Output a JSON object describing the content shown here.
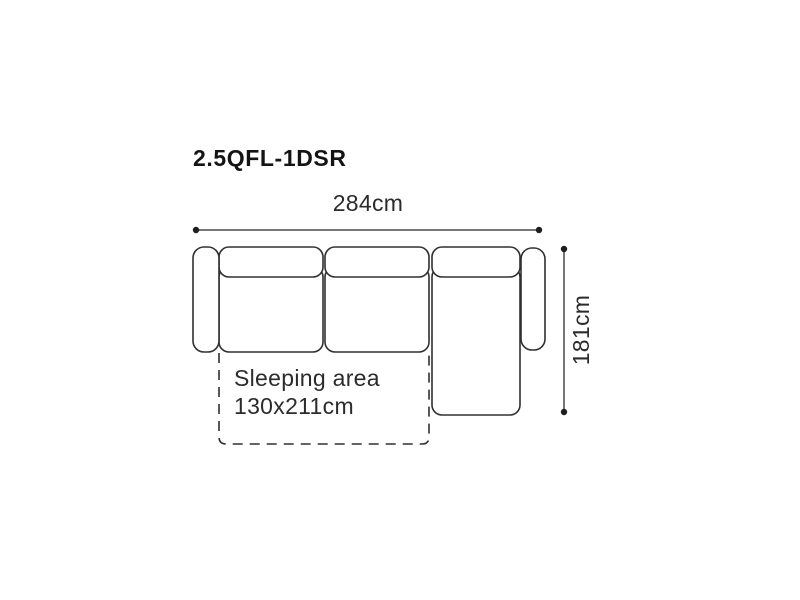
{
  "page": {
    "background_color": "#ffffff"
  },
  "diagram": {
    "title": "2.5QFL-1DSR",
    "width_dimension_label": "284cm",
    "depth_dimension_label": "181cm",
    "sleeping_area": {
      "line1": "Sleeping area",
      "line2": "130x211cm"
    },
    "colors": {
      "sofa_outline": "#303030",
      "dimension_line": "#4a4a4a",
      "dimension_dot": "#1e1e1e",
      "label_text": "#2b2b2b",
      "title_text": "#141414"
    }
  }
}
